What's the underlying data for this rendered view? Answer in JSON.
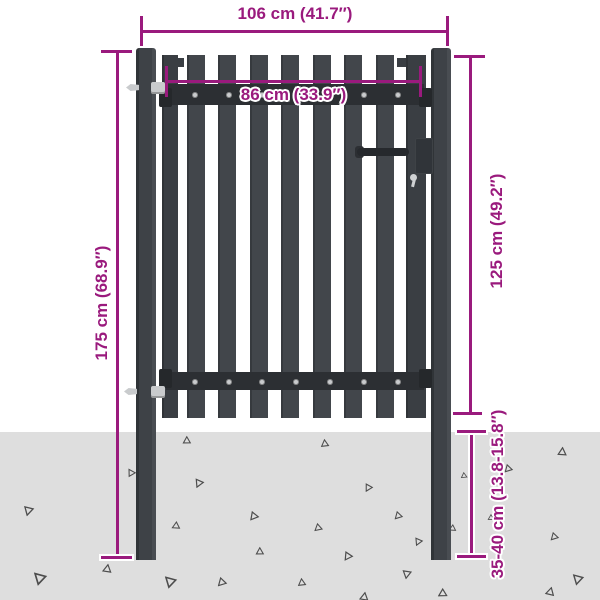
{
  "title": "Garden gate dimension diagram",
  "dimensions": {
    "total_width": {
      "label": "106 cm (41.7″)"
    },
    "gate_width": {
      "label": "86 cm (33.9″)"
    },
    "total_height": {
      "label": "175 cm (68.9″)"
    },
    "gate_height": {
      "label": "125 cm (49.2″)"
    },
    "ground_depth": {
      "label": "35-40 cm (13.8-15.8″)"
    }
  },
  "colors": {
    "dimension_text": "#9a1a7d",
    "gate_slat": "#42464b",
    "gate_stile": "#3a3e43",
    "gate_rail": "#2c2f33",
    "post": "#3e4247",
    "hardware_light": "#c9cbcd",
    "ground": "#dedede",
    "gravel_stroke": "#4d4d4d",
    "background": "#ffffff"
  },
  "gate": {
    "slats": [
      {
        "x": 162,
        "w": 16,
        "stile": true
      },
      {
        "x": 187,
        "w": 18
      },
      {
        "x": 218,
        "w": 18
      },
      {
        "x": 250,
        "w": 18
      },
      {
        "x": 281,
        "w": 18
      },
      {
        "x": 313,
        "w": 18
      },
      {
        "x": 344,
        "w": 18
      },
      {
        "x": 376,
        "w": 18
      },
      {
        "x": 406,
        "w": 20,
        "stile": true
      }
    ],
    "rivet_xs": [
      192,
      226,
      259,
      293,
      327,
      361,
      395
    ],
    "rivet_rows_y": [
      92,
      379
    ]
  },
  "ground": {
    "gravel_triangles": [
      [
        183,
        436,
        9,
        10
      ],
      [
        321,
        439,
        9,
        5
      ],
      [
        558,
        447,
        10,
        15
      ],
      [
        127,
        469,
        9,
        100
      ],
      [
        193,
        478,
        10,
        215
      ],
      [
        363,
        483,
        9,
        220
      ],
      [
        503,
        464,
        9,
        235
      ],
      [
        460,
        472,
        7,
        245
      ],
      [
        22,
        505,
        11,
        205
      ],
      [
        248,
        511,
        10,
        230
      ],
      [
        393,
        511,
        9,
        235
      ],
      [
        171,
        521,
        9,
        255
      ],
      [
        313,
        523,
        9,
        240
      ],
      [
        448,
        524,
        8,
        255
      ],
      [
        549,
        532,
        9,
        235
      ],
      [
        413,
        537,
        9,
        215
      ],
      [
        256,
        547,
        9,
        10
      ],
      [
        342,
        551,
        10,
        225
      ],
      [
        103,
        564,
        10,
        20
      ],
      [
        33,
        570,
        14,
        325
      ],
      [
        401,
        569,
        10,
        200
      ],
      [
        164,
        574,
        13,
        325
      ],
      [
        216,
        577,
        10,
        235
      ],
      [
        298,
        578,
        9,
        5
      ],
      [
        572,
        572,
        12,
        325
      ],
      [
        437,
        588,
        10,
        250
      ],
      [
        360,
        592,
        10,
        20
      ],
      [
        546,
        587,
        10,
        25
      ],
      [
        487,
        514,
        7,
        250
      ]
    ]
  }
}
